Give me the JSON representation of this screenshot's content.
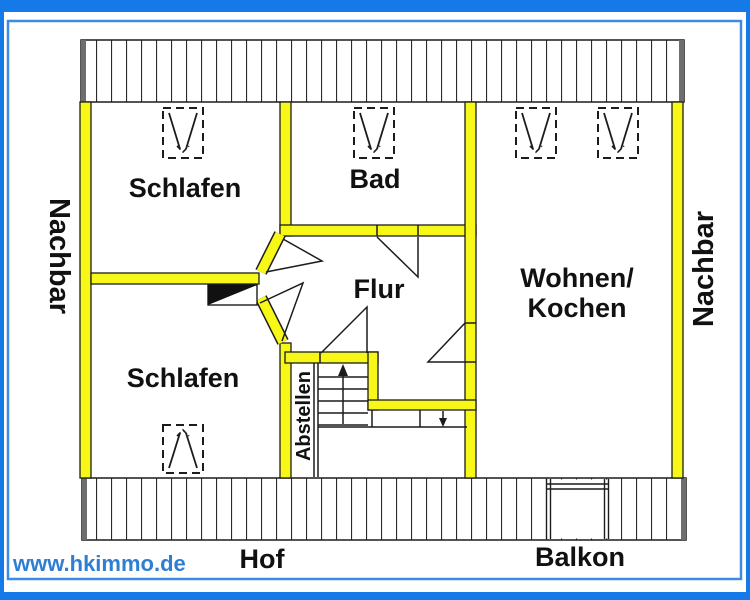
{
  "plan": {
    "type": "floor-plan",
    "labels": {
      "schlafen_top": "Schlafen",
      "bad": "Bad",
      "flur": "Flur",
      "wohnen_line1": "Wohnen/",
      "wohnen_line2": "Kochen",
      "schlafen_bottom": "Schlafen",
      "abstellen": "Abstellen",
      "nachbar_left": "Nachbar",
      "nachbar_right": "Nachbar",
      "hof": "Hof",
      "balkon": "Balkon"
    },
    "icons": {
      "skylight": "roof-window-icon",
      "stairs_up": "arrow-up",
      "stairs_down": "arrow-down",
      "entrance": "door-leaf-filled-triangle"
    },
    "colors": {
      "wall_fill": "#f7f718",
      "line": "#1c1c1c",
      "border_outer": "#1679e8",
      "border_inner": "#3b8ce6",
      "hatch_cap": "#6e6e6e",
      "watermark": "#2e7fd4"
    }
  },
  "watermark": {
    "text": "www.hkimmo.de"
  }
}
